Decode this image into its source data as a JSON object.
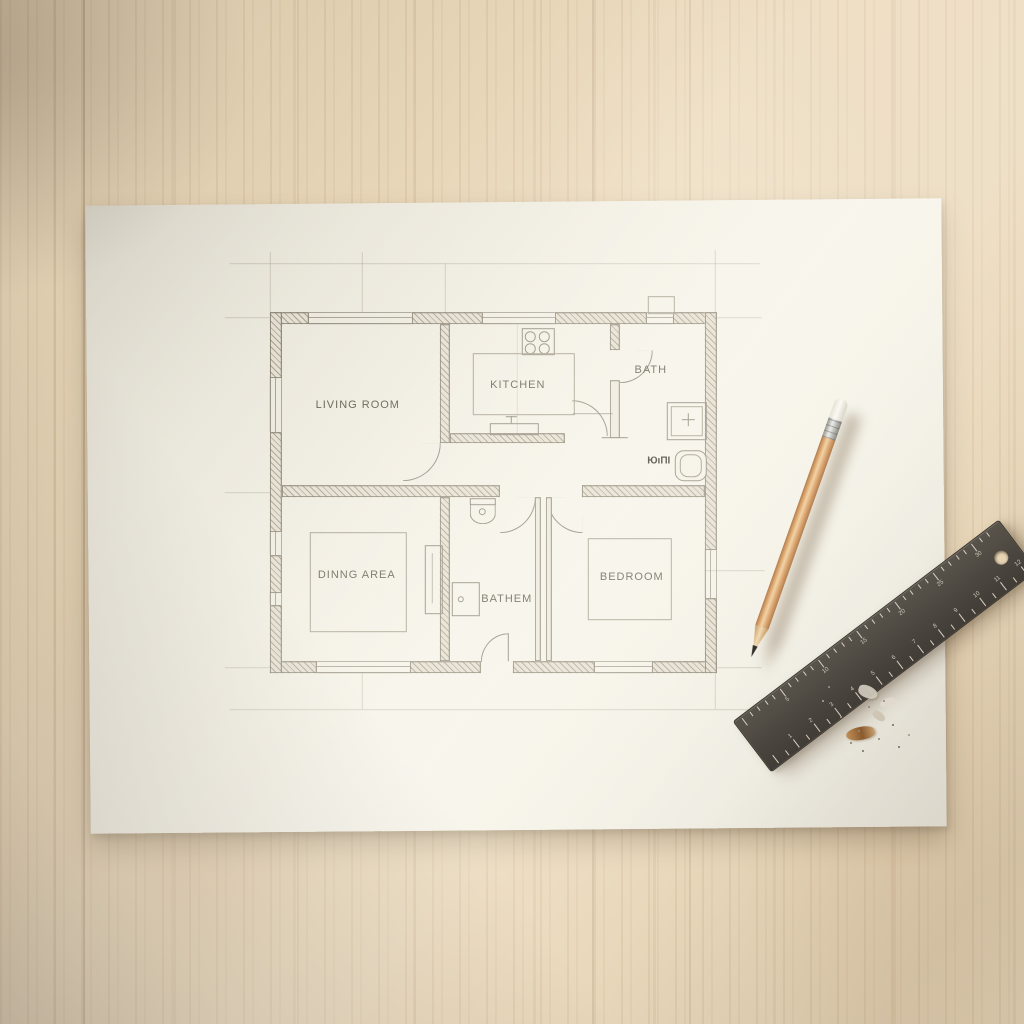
{
  "scene": {
    "description": "Hand-drafted house floor plan on a white sheet of paper lying on a light wooden desk, with a wooden pencil and a dark metal ruler; pencil shavings near the ruler."
  },
  "floor_plan": {
    "rooms": [
      {
        "id": "living_room",
        "label": "LIVING ROOM"
      },
      {
        "id": "kitchen",
        "label": "KITCHEN"
      },
      {
        "id": "bath",
        "label": "BATH"
      },
      {
        "id": "dining_area",
        "label": "DINNG AREA"
      },
      {
        "id": "bathroom",
        "label": "BATHEM"
      },
      {
        "id": "bedroom",
        "label": "BEDROOM"
      },
      {
        "id": "wc_garbled",
        "label": "ЮıΠI"
      }
    ]
  },
  "ruler": {
    "cm_numbers": [
      "5",
      "10",
      "15",
      "20",
      "25",
      "30"
    ],
    "inch_numbers": [
      "1",
      "2",
      "3",
      "4",
      "5",
      "6",
      "7",
      "8",
      "9",
      "10",
      "11",
      "12"
    ]
  },
  "colors": {
    "wood": "#e8d6b8",
    "paper": "#f2efe5",
    "plan_line": "#8a8476",
    "wall_fill": "#e4dfd1",
    "pencil_wood": "#dba770",
    "ruler_body": "#4b463f",
    "label_text": "#5d594b"
  }
}
